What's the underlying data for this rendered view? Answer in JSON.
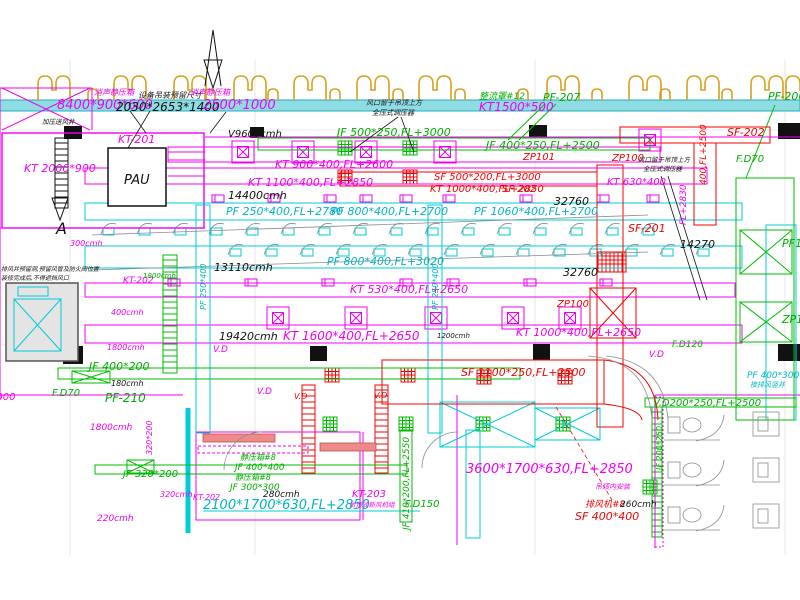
{
  "drawing": {
    "title": "HVAC duct layout plan",
    "colors": {
      "supply_duct": "#f000f0",
      "exhaust_duct": "#00cdd8",
      "fresh_air_duct": "#00bd00",
      "fire_smoke_duct": "#f00404",
      "annotation": "#111111",
      "corridor_band": "#8fdce2",
      "curb_symbol": "#d6a21f"
    },
    "labels": [
      {
        "t": "消声静压箱",
        "x": 94,
        "y": 95,
        "c": "m",
        "s": 8
      },
      {
        "t": "8400*900*600",
        "x": 57,
        "y": 109,
        "c": "m",
        "s": 13
      },
      {
        "t": "设备吊装预留尺寸",
        "x": 138,
        "y": 98,
        "c": "k",
        "s": 8
      },
      {
        "t": "2030*2653*1400",
        "x": 116,
        "y": 111,
        "c": "k",
        "s": 12
      },
      {
        "t": "消声静压箱",
        "x": 190,
        "y": 95,
        "c": "m",
        "s": 8
      },
      {
        "t": "2500*1000",
        "x": 203,
        "y": 109,
        "c": "m",
        "s": 13
      },
      {
        "t": "KT-201",
        "x": 118,
        "y": 143,
        "c": "m",
        "s": 11
      },
      {
        "t": "PAU",
        "x": 124,
        "y": 184,
        "c": "k",
        "s": 13
      },
      {
        "t": "KT 2000*900",
        "x": 24,
        "y": 172,
        "c": "m",
        "s": 11
      },
      {
        "t": "加压送风井",
        "x": 42,
        "y": 124,
        "c": "k",
        "s": 6.5
      },
      {
        "t": "V9600cmh",
        "x": 228,
        "y": 137,
        "c": "k",
        "s": 10
      },
      {
        "t": "风口留于吊顶上方",
        "x": 366,
        "y": 105,
        "c": "k",
        "s": 7
      },
      {
        "t": "全压式调压器",
        "x": 372,
        "y": 115,
        "c": "k",
        "s": 7
      },
      {
        "t": "整流罩#12",
        "x": 479,
        "y": 99,
        "c": "g",
        "s": 9
      },
      {
        "t": "KT1500*500",
        "x": 479,
        "y": 111,
        "c": "m",
        "s": 12
      },
      {
        "t": "PF-207",
        "x": 543,
        "y": 101,
        "c": "g",
        "s": 11
      },
      {
        "t": "PF-206",
        "x": 768,
        "y": 100,
        "c": "g",
        "s": 11
      },
      {
        "t": "JF 500*250,FL+3000",
        "x": 337,
        "y": 136,
        "c": "g",
        "s": 11
      },
      {
        "t": "JF 400*250,FL+2500",
        "x": 486,
        "y": 149,
        "c": "g",
        "s": 11
      },
      {
        "t": "ZP101",
        "x": 523,
        "y": 160,
        "c": "r",
        "s": 10
      },
      {
        "t": "ZP100",
        "x": 612,
        "y": 161,
        "c": "r",
        "s": 10
      },
      {
        "t": "风口留于吊顶上方",
        "x": 638,
        "y": 162,
        "c": "k",
        "s": 6.5
      },
      {
        "t": "全压式调压器",
        "x": 643,
        "y": 171,
        "c": "k",
        "s": 6.5
      },
      {
        "t": "KT 630*400",
        "x": 607,
        "y": 185,
        "c": "m",
        "s": 10
      },
      {
        "t": "SF-202",
        "x": 727,
        "y": 136,
        "c": "r",
        "s": 11
      },
      {
        "t": "F.D70",
        "x": 736,
        "y": 162,
        "c": "g",
        "s": 10
      },
      {
        "t": "400,FL+2500",
        "x": 706,
        "y": 185,
        "c": "r",
        "s": 9,
        "r": -90
      },
      {
        "t": "FL+2830",
        "x": 686,
        "y": 225,
        "c": "m",
        "s": 9,
        "r": -90
      },
      {
        "t": "KT 900*400,FL+2600",
        "x": 275,
        "y": 168,
        "c": "m",
        "s": 11
      },
      {
        "t": "KT 1100*400,FL+2850",
        "x": 248,
        "y": 186,
        "c": "m",
        "s": 11
      },
      {
        "t": "SF 500*200,FL+3000",
        "x": 434,
        "y": 180,
        "c": "r",
        "s": 10
      },
      {
        "t": "KT 1000*400,FL+2850",
        "x": 430,
        "y": 192,
        "c": "r",
        "s": 10
      },
      {
        "t": "SF-202",
        "x": 502,
        "y": 192,
        "c": "r",
        "s": 10
      },
      {
        "t": "14400cmh",
        "x": 228,
        "y": 199,
        "c": "k",
        "s": 11
      },
      {
        "t": "PF 250*400,FL+2780",
        "x": 226,
        "y": 215,
        "c": "c",
        "s": 11
      },
      {
        "t": "PF 800*400,FL+2700",
        "x": 331,
        "y": 215,
        "c": "c",
        "s": 11
      },
      {
        "t": "PF 1060*400,FL+2700",
        "x": 474,
        "y": 215,
        "c": "c",
        "s": 11
      },
      {
        "t": "32760",
        "x": 554,
        "y": 205,
        "c": "k",
        "s": 11
      },
      {
        "t": "13110cmh",
        "x": 214,
        "y": 271,
        "c": "k",
        "s": 11
      },
      {
        "t": "PF 800*400,FL+3020",
        "x": 327,
        "y": 265,
        "c": "c",
        "s": 11
      },
      {
        "t": "KT 530*400,FL+2650",
        "x": 350,
        "y": 293,
        "c": "m",
        "s": 11
      },
      {
        "t": "32760",
        "x": 563,
        "y": 276,
        "c": "k",
        "s": 11
      },
      {
        "t": "SF-201",
        "x": 628,
        "y": 232,
        "c": "r",
        "s": 11
      },
      {
        "t": "14270",
        "x": 680,
        "y": 248,
        "c": "k",
        "s": 11
      },
      {
        "t": "ZP100",
        "x": 557,
        "y": 307,
        "c": "r",
        "s": 10
      },
      {
        "t": "KT 1000*400,FL+2650",
        "x": 516,
        "y": 336,
        "c": "m",
        "s": 11
      },
      {
        "t": "19420cmh",
        "x": 219,
        "y": 340,
        "c": "k",
        "s": 11
      },
      {
        "t": "KT 1600*400,FL+2650",
        "x": 283,
        "y": 340,
        "c": "m",
        "s": 12
      },
      {
        "t": "1200cmh",
        "x": 437,
        "y": 338,
        "c": "k",
        "s": 7
      },
      {
        "t": "SF 1100*250,FL+2500",
        "x": 461,
        "y": 376,
        "c": "r",
        "s": 11
      },
      {
        "t": "V.D",
        "x": 213,
        "y": 352,
        "c": "m",
        "s": 9
      },
      {
        "t": "V.D",
        "x": 257,
        "y": 394,
        "c": "m",
        "s": 9
      },
      {
        "t": "V.D",
        "x": 294,
        "y": 399,
        "c": "r",
        "s": 8
      },
      {
        "t": "V.D",
        "x": 374,
        "y": 398,
        "c": "r",
        "s": 8
      },
      {
        "t": "V.D",
        "x": 649,
        "y": 357,
        "c": "m",
        "s": 9
      },
      {
        "t": "PF10",
        "x": 782,
        "y": 247,
        "c": "g",
        "s": 11
      },
      {
        "t": "ZP10",
        "x": 782,
        "y": 323,
        "c": "g",
        "s": 11
      },
      {
        "t": "F.D120",
        "x": 672,
        "y": 347,
        "c": "g",
        "s": 9
      },
      {
        "t": "PF 400*300",
        "x": 747,
        "y": 378,
        "c": "c",
        "s": 9
      },
      {
        "t": "接排风竖井",
        "x": 750,
        "y": 387,
        "c": "c",
        "s": 7
      },
      {
        "t": "PF 250*400",
        "x": 206,
        "y": 310,
        "c": "c",
        "s": 8,
        "r": -90
      },
      {
        "t": "PF 250*400",
        "x": 438,
        "y": 310,
        "c": "c",
        "s": 8,
        "r": -90
      },
      {
        "t": "A",
        "x": 56,
        "y": 234,
        "c": "k",
        "s": 16
      },
      {
        "t": "300cmh",
        "x": 70,
        "y": 246,
        "c": "m",
        "s": 8
      },
      {
        "t": "排风井预留洞,预留风管及防火阀位置",
        "x": 1,
        "y": 271,
        "c": "k",
        "s": 6
      },
      {
        "t": "装修完成后,不得遮挡风口",
        "x": 1,
        "y": 280,
        "c": "k",
        "s": 6
      },
      {
        "t": "KT-202",
        "x": 123,
        "y": 283,
        "c": "m",
        "s": 9
      },
      {
        "t": "1800cmh",
        "x": 143,
        "y": 278,
        "c": "g",
        "s": 7
      },
      {
        "t": "400cmh",
        "x": 111,
        "y": 315,
        "c": "m",
        "s": 8
      },
      {
        "t": "1800cmh",
        "x": 107,
        "y": 350,
        "c": "m",
        "s": 8
      },
      {
        "t": "JF 400*200",
        "x": 89,
        "y": 370,
        "c": "g",
        "s": 11
      },
      {
        "t": "180cmh",
        "x": 111,
        "y": 386,
        "c": "k",
        "s": 8
      },
      {
        "t": "F.D70",
        "x": 52,
        "y": 396,
        "c": "g",
        "s": 10
      },
      {
        "t": "PF-210",
        "x": 105,
        "y": 402,
        "c": "g",
        "s": 12
      },
      {
        "t": "1800cmh",
        "x": 90,
        "y": 430,
        "c": "m",
        "s": 9
      },
      {
        "t": "2000",
        "x": -10,
        "y": 400,
        "c": "m",
        "s": 10
      },
      {
        "t": "320*200",
        "x": 152,
        "y": 455,
        "c": "m",
        "s": 8,
        "r": -90
      },
      {
        "t": "JF 320*200",
        "x": 123,
        "y": 477,
        "c": "g",
        "s": 10
      },
      {
        "t": "220cmh",
        "x": 97,
        "y": 521,
        "c": "m",
        "s": 9
      },
      {
        "t": "320cmh",
        "x": 160,
        "y": 497,
        "c": "m",
        "s": 8
      },
      {
        "t": "KT-202",
        "x": 193,
        "y": 500,
        "c": "m",
        "s": 8
      },
      {
        "t": "2100*1700*630,FL+2850",
        "x": 203,
        "y": 509,
        "c": "c",
        "s": 13
      },
      {
        "t": "280cmh",
        "x": 263,
        "y": 497,
        "c": "k",
        "s": 9
      },
      {
        "t": "静压箱#8",
        "x": 240,
        "y": 460,
        "c": "g",
        "s": 8
      },
      {
        "t": "JF 400*400",
        "x": 235,
        "y": 470,
        "c": "g",
        "s": 9
      },
      {
        "t": "静压箱#8",
        "x": 235,
        "y": 480,
        "c": "g",
        "s": 8
      },
      {
        "t": "JF 300*300",
        "x": 230,
        "y": 490,
        "c": "g",
        "s": 9
      },
      {
        "t": "KT-203",
        "x": 352,
        "y": 497,
        "c": "m",
        "s": 10
      },
      {
        "t": "吊顶式新风机组",
        "x": 349,
        "y": 507,
        "c": "m",
        "s": 6.5
      },
      {
        "t": "JF 410*200,FL+2550",
        "x": 409,
        "y": 530,
        "c": "g",
        "s": 9,
        "r": -90
      },
      {
        "t": "F.D150",
        "x": 405,
        "y": 507,
        "c": "g",
        "s": 10
      },
      {
        "t": "3600*1700*630,FL+2850",
        "x": 466,
        "y": 473,
        "c": "m",
        "s": 13
      },
      {
        "t": "吊顶内安装",
        "x": 595,
        "y": 489,
        "c": "m",
        "s": 7
      },
      {
        "t": "排风机#8",
        "x": 585,
        "y": 507,
        "c": "r",
        "s": 9
      },
      {
        "t": "260cmh",
        "x": 620,
        "y": 507,
        "c": "k",
        "s": 9
      },
      {
        "t": "SF 400*400",
        "x": 575,
        "y": 520,
        "c": "r",
        "s": 11
      },
      {
        "t": "V.D200*250,FL+2500",
        "x": 653,
        "y": 406,
        "c": "g",
        "s": 10
      },
      {
        "t": "JF 200*250",
        "x": 662,
        "y": 470,
        "c": "g",
        "s": 8,
        "r": -90
      }
    ]
  }
}
